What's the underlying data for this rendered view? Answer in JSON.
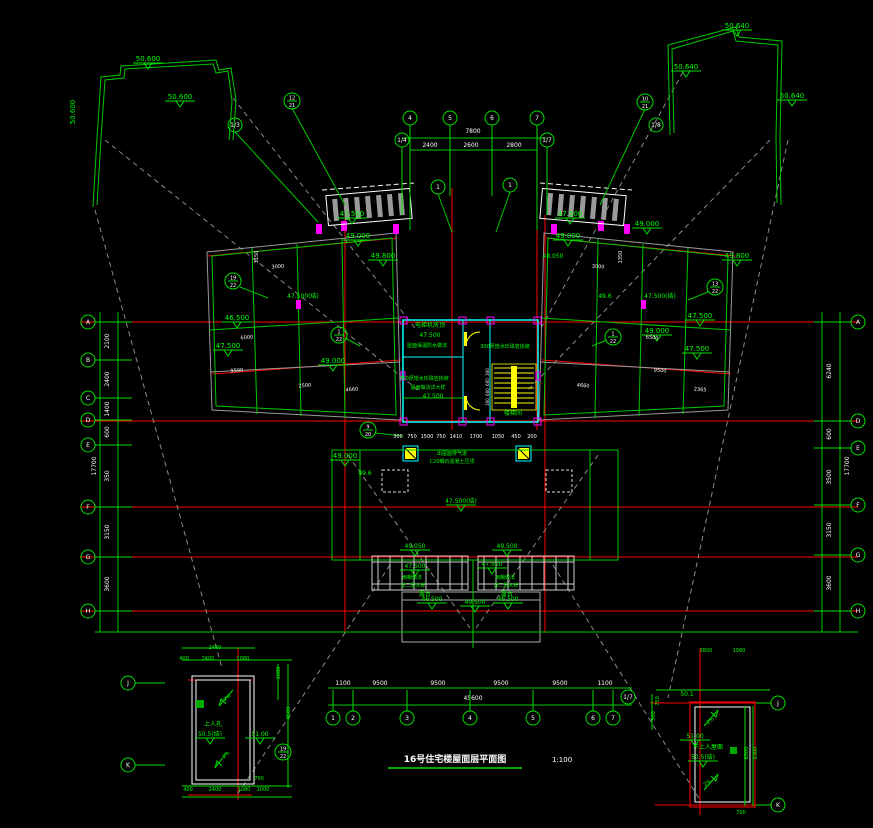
{
  "colors": {
    "bg": "#000000",
    "green": "#00e000",
    "green_text": "#00ff00",
    "red": "#ff0000",
    "cyan": "#00ffff",
    "magenta": "#ff00ff",
    "yellow": "#ffff00",
    "gray": "#9a9a9a",
    "white": "#ffffff"
  },
  "title": {
    "text": "16号住宅楼屋面层平面图",
    "scale": "1:100"
  },
  "rooms": {
    "elevator_room": "电梯机房顶",
    "stair_room": "楼梯间",
    "roof_note": "300厚憎水珍珠岩找坡",
    "insulation_note": "屋面保温防水做法",
    "canopy_note": "雨棚做法 详二层大样",
    "terrace": "露台",
    "hatch": "上人孔",
    "inaccessible_roof": "不上人屋面",
    "vent_note": "出屋面排气道",
    "capping_note": "C20细石混凝土压顶"
  },
  "bubbles": {
    "left": [
      {
        "x": 88,
        "y": 322,
        "l": "A"
      },
      {
        "x": 88,
        "y": 360,
        "l": "B"
      },
      {
        "x": 88,
        "y": 398,
        "l": "C"
      },
      {
        "x": 88,
        "y": 420,
        "l": "D"
      },
      {
        "x": 88,
        "y": 445,
        "l": "E"
      },
      {
        "x": 88,
        "y": 507,
        "l": "F"
      },
      {
        "x": 88,
        "y": 557,
        "l": "G"
      },
      {
        "x": 88,
        "y": 611,
        "l": "H"
      }
    ],
    "right": [
      {
        "x": 858,
        "y": 322,
        "l": "A"
      },
      {
        "x": 858,
        "y": 421,
        "l": "D"
      },
      {
        "x": 858,
        "y": 448,
        "l": "E"
      },
      {
        "x": 858,
        "y": 505,
        "l": "F"
      },
      {
        "x": 858,
        "y": 555,
        "l": "G"
      },
      {
        "x": 858,
        "y": 611,
        "l": "H"
      }
    ],
    "top": [
      {
        "x": 410,
        "y": 118,
        "l": "4"
      },
      {
        "x": 450,
        "y": 118,
        "l": "5"
      },
      {
        "x": 492,
        "y": 118,
        "l": "6"
      },
      {
        "x": 537,
        "y": 118,
        "l": "7"
      },
      {
        "x": 402,
        "y": 140,
        "l": "1/4"
      },
      {
        "x": 547,
        "y": 140,
        "l": "1/7"
      }
    ],
    "bottom": [
      {
        "x": 333,
        "y": 718,
        "l": "1"
      },
      {
        "x": 353,
        "y": 718,
        "l": "2"
      },
      {
        "x": 407,
        "y": 718,
        "l": "3"
      },
      {
        "x": 470,
        "y": 718,
        "l": "4"
      },
      {
        "x": 533,
        "y": 718,
        "l": "5"
      },
      {
        "x": 593,
        "y": 718,
        "l": "6"
      },
      {
        "x": 613,
        "y": 718,
        "l": "7"
      }
    ],
    "floating": [
      {
        "x": 235,
        "y": 125,
        "l": "1/3"
      },
      {
        "x": 656,
        "y": 125,
        "l": "1/8"
      },
      {
        "x": 292,
        "y": 101,
        "l": "12",
        "l2": "21"
      },
      {
        "x": 645,
        "y": 102,
        "l": "10",
        "l2": "21"
      },
      {
        "x": 233,
        "y": 281,
        "l": "19",
        "l2": "22"
      },
      {
        "x": 715,
        "y": 287,
        "l": "13",
        "l2": "22"
      },
      {
        "x": 339,
        "y": 335,
        "l": "1",
        "l2": "22"
      },
      {
        "x": 613,
        "y": 337,
        "l": "1",
        "l2": "22"
      },
      {
        "x": 438,
        "y": 187,
        "l": "1"
      },
      {
        "x": 510,
        "y": 185,
        "l": "1"
      },
      {
        "x": 368,
        "y": 430,
        "l": "9",
        "l2": "20"
      },
      {
        "x": 283,
        "y": 752,
        "l": "19",
        "l2": "22"
      },
      {
        "x": 128,
        "y": 683,
        "l": "J"
      },
      {
        "x": 128,
        "y": 765,
        "l": "K"
      },
      {
        "x": 778,
        "y": 703,
        "l": "J"
      },
      {
        "x": 778,
        "y": 805,
        "l": "K"
      },
      {
        "x": 628,
        "y": 697,
        "l": "1/7"
      }
    ]
  },
  "annotations": [
    {
      "x": 148,
      "y": 61,
      "t": "50.600",
      "m": 1
    },
    {
      "x": 180,
      "y": 99,
      "t": "50.600",
      "m": 1
    },
    {
      "x": 75,
      "y": 112,
      "t": "50.600",
      "r": -90
    },
    {
      "x": 737,
      "y": 28,
      "t": "50.640",
      "m": 1
    },
    {
      "x": 686,
      "y": 69,
      "t": "50.640",
      "m": 1
    },
    {
      "x": 792,
      "y": 98,
      "t": "50.640",
      "m": 1
    },
    {
      "x": 352,
      "y": 216,
      "t": "47.500",
      "m": 1
    },
    {
      "x": 570,
      "y": 216,
      "t": "47.500",
      "m": 1
    },
    {
      "x": 383,
      "y": 258,
      "t": "49.800",
      "m": 1
    },
    {
      "x": 737,
      "y": 258,
      "t": "49.800",
      "m": 1
    },
    {
      "x": 358,
      "y": 238,
      "t": "49.000",
      "m": 1
    },
    {
      "x": 568,
      "y": 238,
      "t": "49.000",
      "m": 1
    },
    {
      "x": 237,
      "y": 320,
      "t": "46.500",
      "m": 1
    },
    {
      "x": 228,
      "y": 348,
      "t": "47.500",
      "m": 1
    },
    {
      "x": 303,
      "y": 298,
      "t": "47.500(结)",
      "s": 6
    },
    {
      "x": 660,
      "y": 298,
      "t": "47.500(结)",
      "s": 6
    },
    {
      "x": 605,
      "y": 298,
      "t": "49.6",
      "s": 6
    },
    {
      "x": 553,
      "y": 258,
      "t": "48.050",
      "s": 6
    },
    {
      "x": 647,
      "y": 226,
      "t": "49.000",
      "m": 1
    },
    {
      "x": 700,
      "y": 318,
      "t": "47.500",
      "m": 1
    },
    {
      "x": 657,
      "y": 333,
      "t": "49.000",
      "m": 1
    },
    {
      "x": 697,
      "y": 351,
      "t": "47.500",
      "m": 1
    },
    {
      "x": 333,
      "y": 363,
      "t": "49.000",
      "m": 1
    },
    {
      "x": 365,
      "y": 475,
      "t": "49.6",
      "s": 6
    },
    {
      "x": 345,
      "y": 458,
      "t": "49.000",
      "m": 1
    },
    {
      "x": 461,
      "y": 503,
      "t": "47.500(结)",
      "s": 6,
      "m": 1
    },
    {
      "x": 415,
      "y": 548,
      "t": "49.050",
      "s": 6,
      "m": 1
    },
    {
      "x": 507,
      "y": 548,
      "t": "49.500",
      "s": 6,
      "m": 1
    },
    {
      "x": 415,
      "y": 568,
      "t": "47.500",
      "s": 6,
      "m": 1
    },
    {
      "x": 492,
      "y": 566,
      "t": "47.500",
      "s": 6,
      "m": 1
    },
    {
      "x": 432,
      "y": 601,
      "t": "46.500",
      "s": 6,
      "m": 1
    },
    {
      "x": 475,
      "y": 604,
      "t": "49.500",
      "s": 6,
      "m": 1
    },
    {
      "x": 508,
      "y": 601,
      "t": "46.500",
      "s": 6,
      "m": 1
    },
    {
      "x": 210,
      "y": 736,
      "t": "50.5(结)",
      "s": 6,
      "m": 1
    },
    {
      "x": 260,
      "y": 736,
      "t": "51.00",
      "s": 6,
      "m": 1
    },
    {
      "x": 695,
      "y": 738,
      "t": "51.00",
      "s": 6,
      "m": 1
    },
    {
      "x": 703,
      "y": 759,
      "t": "50.5(结)",
      "s": 6,
      "m": 1
    },
    {
      "x": 687,
      "y": 696,
      "t": "50.1",
      "s": 6
    },
    {
      "x": 430,
      "y": 327,
      "t": "电梯机房顶",
      "s": 6
    },
    {
      "x": 430,
      "y": 337,
      "t": "47.500",
      "s": 6
    },
    {
      "x": 427,
      "y": 347,
      "t": "屋面保温防水做法",
      "s": 5
    },
    {
      "x": 505,
      "y": 348,
      "t": "300厚憎水珍珠岩找坡",
      "s": 5
    },
    {
      "x": 513,
      "y": 415,
      "t": "楼梯间",
      "s": 6
    },
    {
      "x": 424,
      "y": 380,
      "t": "300厚憎水珍珠岩找坡",
      "s": 5
    },
    {
      "x": 428,
      "y": 389,
      "t": "屋面做法详大样",
      "s": 5
    },
    {
      "x": 433,
      "y": 398,
      "t": "47.500",
      "s": 6
    },
    {
      "x": 412,
      "y": 579,
      "t": "雨棚做法",
      "s": 5
    },
    {
      "x": 413,
      "y": 587,
      "t": "详二层大样",
      "s": 5
    },
    {
      "x": 505,
      "y": 579,
      "t": "雨棚做法",
      "s": 5
    },
    {
      "x": 506,
      "y": 587,
      "t": "详二层大样",
      "s": 5
    },
    {
      "x": 425,
      "y": 596,
      "t": "露台",
      "s": 6
    },
    {
      "x": 507,
      "y": 596,
      "t": "露台",
      "s": 6
    },
    {
      "x": 213,
      "y": 726,
      "t": "上人孔",
      "s": 6
    },
    {
      "x": 708,
      "y": 749,
      "t": "不上人屋面",
      "s": 6
    },
    {
      "x": 452,
      "y": 455,
      "t": "出屋面排气道",
      "s": 5
    },
    {
      "x": 452,
      "y": 463,
      "t": "C20细石混凝土压顶",
      "s": 5
    },
    {
      "x": 228,
      "y": 699,
      "t": "2%",
      "s": 5,
      "r": -40
    },
    {
      "x": 227,
      "y": 756,
      "t": "2%",
      "s": 5,
      "r": -40
    },
    {
      "x": 711,
      "y": 722,
      "t": "2%",
      "s": 5,
      "r": -40
    },
    {
      "x": 708,
      "y": 784,
      "t": "2%",
      "s": 5,
      "r": -40
    },
    {
      "x": 473,
      "y": 133,
      "t": "7800",
      "c": "#ffffff",
      "s": 6
    },
    {
      "x": 430,
      "y": 147,
      "t": "2400",
      "c": "#ffffff",
      "s": 6
    },
    {
      "x": 471,
      "y": 147,
      "t": "2600",
      "c": "#ffffff",
      "s": 6
    },
    {
      "x": 514,
      "y": 147,
      "t": "2800",
      "c": "#ffffff",
      "s": 6
    },
    {
      "x": 109,
      "y": 341,
      "t": "2100",
      "c": "#ffffff",
      "s": 6,
      "r": -90
    },
    {
      "x": 109,
      "y": 379,
      "t": "2400",
      "c": "#ffffff",
      "s": 6,
      "r": -90
    },
    {
      "x": 109,
      "y": 409,
      "t": "1400",
      "c": "#ffffff",
      "s": 6,
      "r": -90
    },
    {
      "x": 109,
      "y": 432,
      "t": "600",
      "c": "#ffffff",
      "s": 6,
      "r": -90
    },
    {
      "x": 109,
      "y": 476,
      "t": "350",
      "c": "#ffffff",
      "s": 6,
      "r": -90
    },
    {
      "x": 109,
      "y": 532,
      "t": "3150",
      "c": "#ffffff",
      "s": 6,
      "r": -90
    },
    {
      "x": 109,
      "y": 584,
      "t": "3600",
      "c": "#ffffff",
      "s": 6,
      "r": -90
    },
    {
      "x": 96,
      "y": 466,
      "t": "17700",
      "c": "#ffffff",
      "s": 6,
      "r": -90
    },
    {
      "x": 831,
      "y": 371,
      "t": "6240",
      "c": "#ffffff",
      "s": 6,
      "r": -90
    },
    {
      "x": 831,
      "y": 434,
      "t": "600",
      "c": "#ffffff",
      "s": 6,
      "r": -90
    },
    {
      "x": 831,
      "y": 477,
      "t": "3500",
      "c": "#ffffff",
      "s": 6,
      "r": -90
    },
    {
      "x": 831,
      "y": 530,
      "t": "3150",
      "c": "#ffffff",
      "s": 6,
      "r": -90
    },
    {
      "x": 831,
      "y": 583,
      "t": "3600",
      "c": "#ffffff",
      "s": 6,
      "r": -90
    },
    {
      "x": 849,
      "y": 466,
      "t": "17700",
      "c": "#ffffff",
      "s": 6,
      "r": -90
    },
    {
      "x": 343,
      "y": 685,
      "t": "1100",
      "c": "#ffffff",
      "s": 6
    },
    {
      "x": 380,
      "y": 685,
      "t": "9500",
      "c": "#ffffff",
      "s": 6
    },
    {
      "x": 438,
      "y": 685,
      "t": "9500",
      "c": "#ffffff",
      "s": 6
    },
    {
      "x": 501,
      "y": 685,
      "t": "9500",
      "c": "#ffffff",
      "s": 6
    },
    {
      "x": 560,
      "y": 685,
      "t": "9500",
      "c": "#ffffff",
      "s": 6
    },
    {
      "x": 605,
      "y": 685,
      "t": "1100",
      "c": "#ffffff",
      "s": 6
    },
    {
      "x": 473,
      "y": 700,
      "t": "45600",
      "c": "#ffffff",
      "s": 6
    },
    {
      "x": 398,
      "y": 438,
      "t": "300",
      "c": "#ffffff",
      "s": 5
    },
    {
      "x": 412,
      "y": 438,
      "t": "750",
      "c": "#ffffff",
      "s": 5
    },
    {
      "x": 427,
      "y": 438,
      "t": "1500",
      "c": "#ffffff",
      "s": 5
    },
    {
      "x": 441,
      "y": 438,
      "t": "750",
      "c": "#ffffff",
      "s": 5
    },
    {
      "x": 456,
      "y": 438,
      "t": "1410",
      "c": "#ffffff",
      "s": 5
    },
    {
      "x": 476,
      "y": 438,
      "t": "1700",
      "c": "#ffffff",
      "s": 5
    },
    {
      "x": 498,
      "y": 438,
      "t": "1050",
      "c": "#ffffff",
      "s": 5
    },
    {
      "x": 516,
      "y": 438,
      "t": "450",
      "c": "#ffffff",
      "s": 5
    },
    {
      "x": 532,
      "y": 438,
      "t": "200",
      "c": "#ffffff",
      "s": 5
    },
    {
      "x": 278,
      "y": 268,
      "t": "3000",
      "c": "#ffffff",
      "s": 5,
      "r": -5
    },
    {
      "x": 247,
      "y": 339,
      "t": "6000",
      "c": "#ffffff",
      "s": 5,
      "r": -5
    },
    {
      "x": 237,
      "y": 372,
      "t": "9500",
      "c": "#ffffff",
      "s": 5,
      "r": -5
    },
    {
      "x": 305,
      "y": 387,
      "t": "2500",
      "c": "#ffffff",
      "s": 5,
      "r": -5
    },
    {
      "x": 352,
      "y": 391,
      "t": "4660",
      "c": "#ffffff",
      "s": 5,
      "r": -5
    },
    {
      "x": 258,
      "y": 257,
      "t": "3150",
      "c": "#ffffff",
      "s": 5,
      "r": -90
    },
    {
      "x": 598,
      "y": 268,
      "t": "3000",
      "c": "#ffffff",
      "s": 5,
      "r": 5
    },
    {
      "x": 652,
      "y": 339,
      "t": "6500",
      "c": "#ffffff",
      "s": 5,
      "r": 5
    },
    {
      "x": 660,
      "y": 372,
      "t": "9500",
      "c": "#ffffff",
      "s": 5,
      "r": 5
    },
    {
      "x": 583,
      "y": 387,
      "t": "4660",
      "c": "#ffffff",
      "s": 5,
      "r": 5
    },
    {
      "x": 700,
      "y": 391,
      "t": "2365",
      "c": "#ffffff",
      "s": 5,
      "r": 5
    },
    {
      "x": 622,
      "y": 257,
      "t": "1350",
      "c": "#ffffff",
      "s": 5,
      "r": -90
    },
    {
      "x": 489,
      "y": 372,
      "t": "300",
      "c": "#ffffff",
      "s": 4,
      "r": -90
    },
    {
      "x": 489,
      "y": 382,
      "t": "600",
      "c": "#ffffff",
      "s": 4,
      "r": -90
    },
    {
      "x": 489,
      "y": 392,
      "t": "600",
      "c": "#ffffff",
      "s": 4,
      "r": -90
    },
    {
      "x": 489,
      "y": 402,
      "t": "300",
      "c": "#ffffff",
      "s": 4,
      "r": -90
    },
    {
      "x": 215,
      "y": 649,
      "t": "2400",
      "s": 5
    },
    {
      "x": 208,
      "y": 660,
      "t": "2400",
      "s": 5
    },
    {
      "x": 243,
      "y": 660,
      "t": "1080",
      "s": 5
    },
    {
      "x": 184,
      "y": 660,
      "t": "400",
      "s": 5
    },
    {
      "x": 290,
      "y": 713,
      "t": "4580",
      "s": 5,
      "r": -90
    },
    {
      "x": 280,
      "y": 673,
      "t": "1080",
      "s": 5,
      "r": -90
    },
    {
      "x": 215,
      "y": 791,
      "t": "2400",
      "s": 5
    },
    {
      "x": 244,
      "y": 791,
      "t": "1080",
      "s": 5
    },
    {
      "x": 263,
      "y": 791,
      "t": "1000",
      "s": 5
    },
    {
      "x": 188,
      "y": 791,
      "t": "400",
      "s": 5
    },
    {
      "x": 259,
      "y": 780,
      "t": "700",
      "s": 5
    },
    {
      "x": 706,
      "y": 652,
      "t": "2800",
      "s": 5
    },
    {
      "x": 739,
      "y": 652,
      "t": "1080",
      "s": 5
    },
    {
      "x": 659,
      "y": 701,
      "t": "750",
      "s": 5,
      "r": -90
    },
    {
      "x": 655,
      "y": 716,
      "t": "500",
      "s": 5,
      "r": -90
    },
    {
      "x": 748,
      "y": 753,
      "t": "6300",
      "s": 5,
      "r": -90
    },
    {
      "x": 757,
      "y": 753,
      "t": "6300",
      "s": 5,
      "r": -90
    },
    {
      "x": 741,
      "y": 814,
      "t": "700",
      "s": 5
    }
  ]
}
